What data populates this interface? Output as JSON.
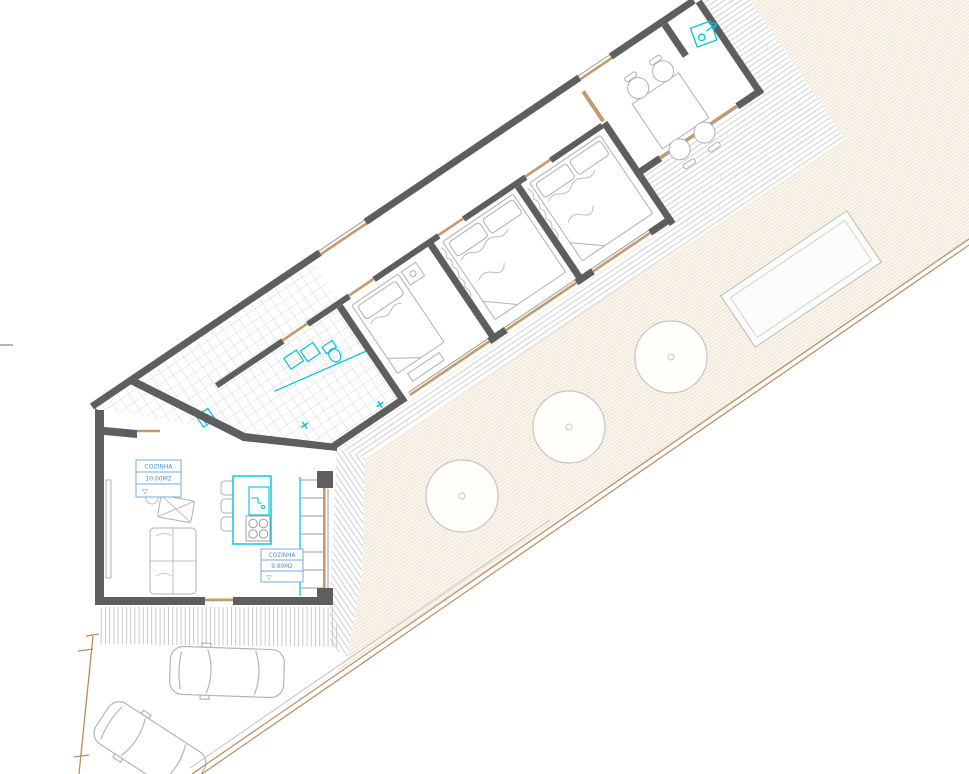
{
  "page": {
    "background": "#ffffff",
    "drawing_type": "architectural site / floor plan"
  },
  "labels": {
    "zone1": {
      "name": "COZINHA",
      "area": "10.00M2",
      "level_mark": "▽"
    },
    "zone2": {
      "name": "COZINHA",
      "area": "9.80M2",
      "level_mark": "▽"
    }
  },
  "colors": {
    "wall": "#5e5e5e",
    "fixture_cyan": "#00c3d8",
    "label_blue": "#4a90d0",
    "label_border": "#74aede",
    "timber_tan": "#c49a6c",
    "boundary_tan": "#b98c62",
    "deck_line": "#cbcbcb",
    "garden_line": "#eadfcc",
    "garden_fill": "#faf6ee",
    "furniture_line": "#b0b0b0",
    "tile_line": "#cfcfcf",
    "tree_line": "#c6c6c6"
  },
  "site": {
    "tree_count": 3,
    "car_count": 2,
    "pool_count": 1,
    "bedroom_count": 3
  }
}
